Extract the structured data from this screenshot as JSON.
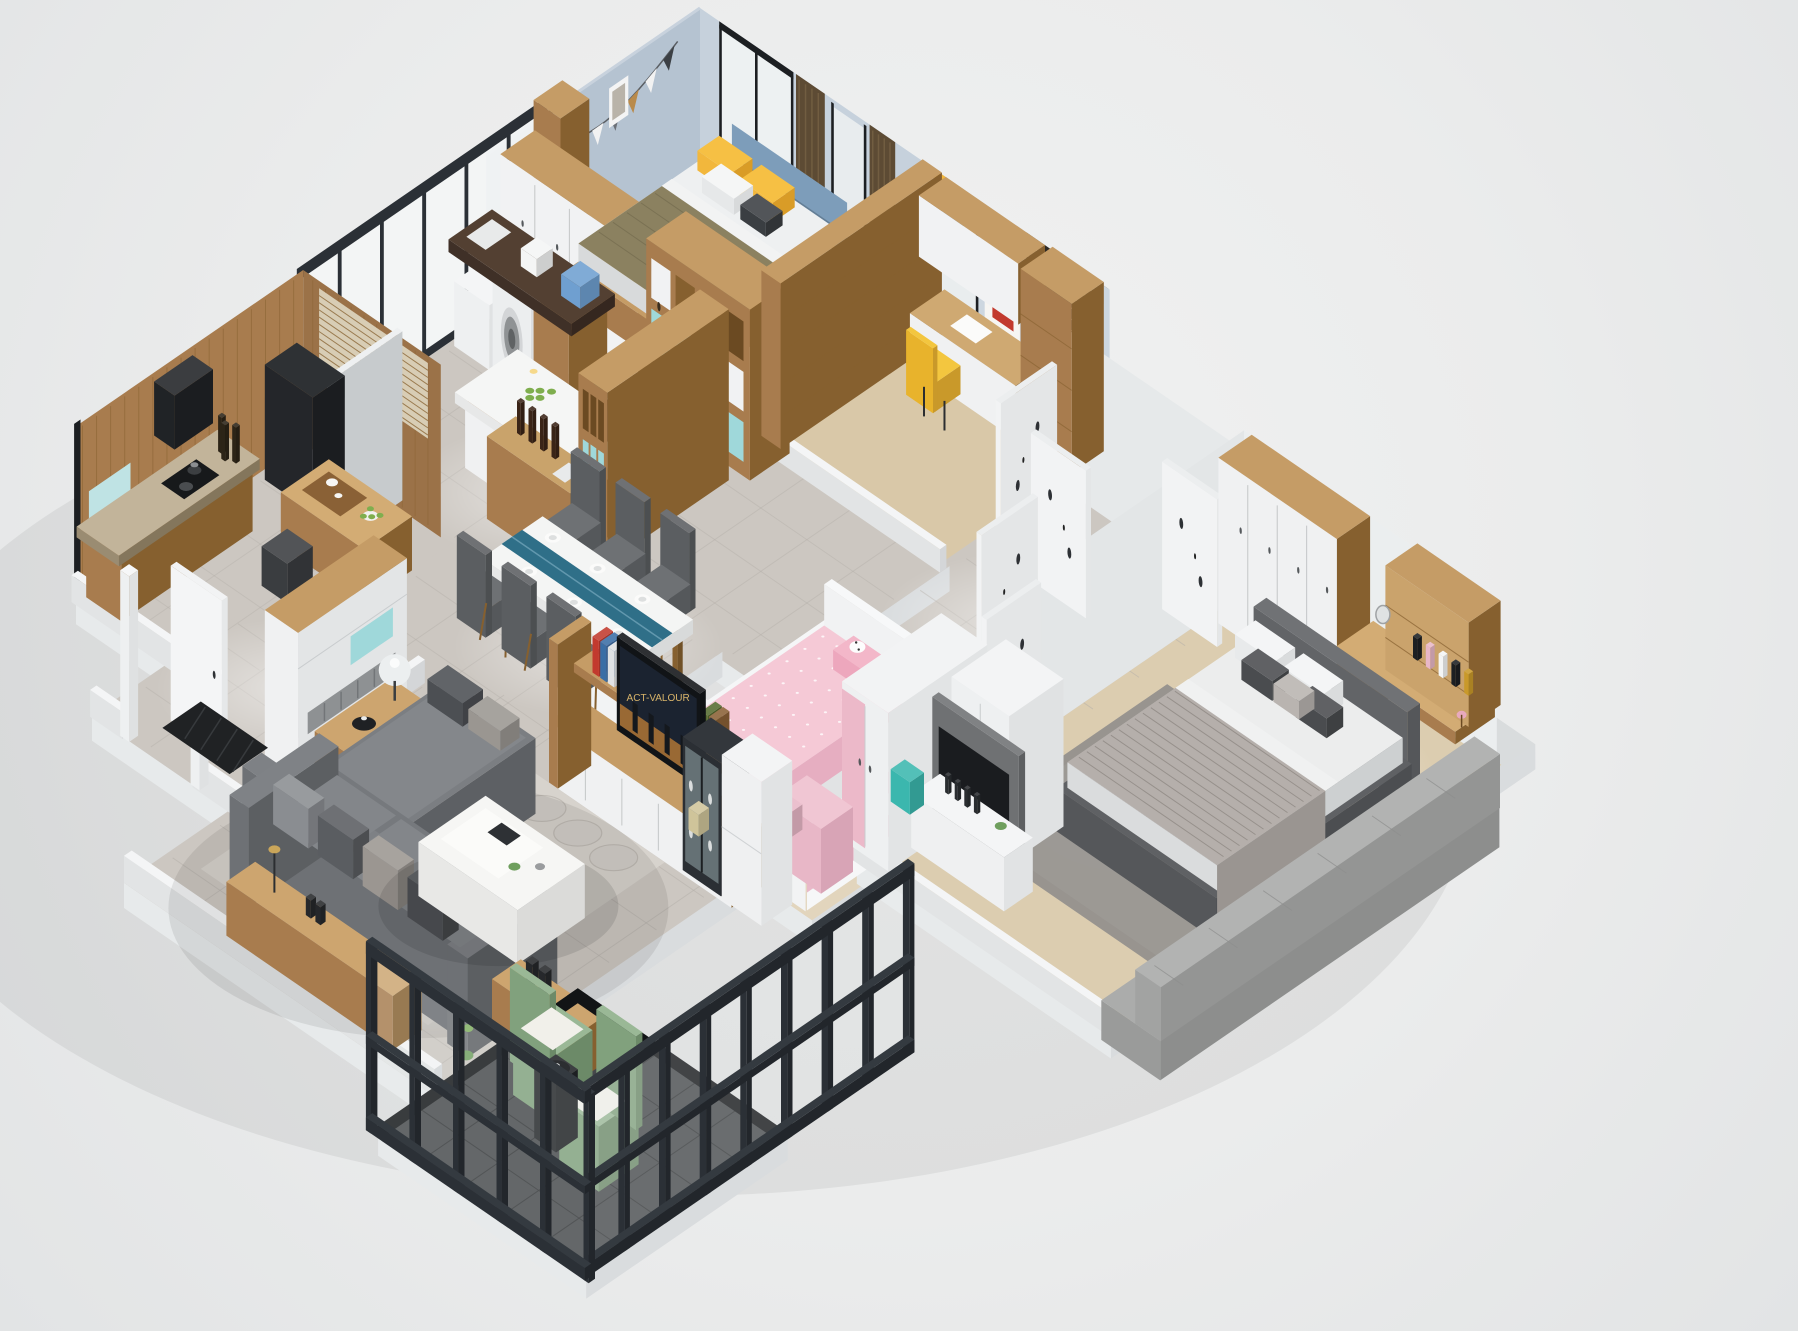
{
  "scene": {
    "description": "Isometric 3D cutaway render of a furnished three-bedroom apartment floor plan on a light gray studio background",
    "background_color": "#ebecec",
    "tv_screen_label": "ACT-VALOUR"
  },
  "palette": {
    "slab_top": "#d9dcdd",
    "slab_side": "#c9cdcf",
    "marble": "#ccc7c1",
    "marble_lt": "#dedad4",
    "tile_line": "#b4afa9",
    "wood": "#a87c4e",
    "wood_dk": "#86602f",
    "wood_lt": "#c59c66",
    "wood_floor": "#d9c8a8",
    "wood_floor2": "#e2d5bd",
    "wood_top": "#d3ac74",
    "white": "#f1f2f3",
    "white_dk": "#d7d9da",
    "gray_wall": "#e4e7e8",
    "blue_wall": "#b5c3d1",
    "blue_wall_lt": "#c6d1dc",
    "teal": "#9fd8da",
    "teal_dk": "#79c4c8",
    "yellow": "#f2b73c",
    "olive": "#8b8160",
    "head_blue": "#7d9dba",
    "pink": "#f5c9d6",
    "pink_dk": "#e6aec1",
    "sofa": "#6d7073",
    "sofa_dk": "#5a5d60",
    "sofa_lt": "#83868a",
    "green": "#81a17d",
    "green_lt": "#9ab896",
    "black": "#1c1f22",
    "frame": "#2b3036",
    "glass": "#f3f5f5",
    "granite": "#4e3d31",
    "granite_lt": "#c2b49a",
    "curtain": "#5d4b34",
    "curtain_lt": "#7a6547",
    "rug": "#d7d3cd",
    "rug_line": "#b7b2ac",
    "rug_gray": "#93908d",
    "bed_frame": "#5d5f62",
    "bedding": "#eceded",
    "throw": "#b5afab",
    "bench": "#a9aaa9",
    "balcony_floor": "#46484b",
    "balcony_line": "#2e3032",
    "mat": "#202224",
    "poster_red": "#c23a2e",
    "screen": "#1b2330",
    "screen_glow": "#b97b36",
    "label": "#d8b46a"
  },
  "rooms": [
    {
      "id": "bedroom-2",
      "label": "Teen bedroom with blue walls and yellow bedding",
      "furniture": [
        "white-door wardrobe",
        "single bed with yellow pillows",
        "bunting garland",
        "star and hexagon wall decor",
        "black framed windows",
        "brown curtains",
        "shelving divider"
      ]
    },
    {
      "id": "bedroom-3",
      "label": "Study bedroom",
      "furniture": [
        "desk with hutch",
        "yellow chair",
        "rhino-in-suit poster",
        "colorful wall shelves",
        "dark roller blind"
      ]
    },
    {
      "id": "hallway",
      "label": "Hallway with marble floor",
      "furniture": [
        "white doors with black leaf decals"
      ]
    },
    {
      "id": "master-bedroom",
      "label": "Master bedroom",
      "furniture": [
        "upholstered double bed",
        "striped throw",
        "wood wardrobe with white doors",
        "corner vanity desk with cosmetics hutch",
        "pleated pouf",
        "gray rug",
        "tv panel with white sideboard",
        "gray window bench platform"
      ]
    },
    {
      "id": "kids-room",
      "label": "Children's room",
      "furniture": [
        "white bed with pink hello-kitty bedding",
        "pink and white wardrobe",
        "pink desk",
        "pink striped wall"
      ]
    },
    {
      "id": "kitchen",
      "label": "Kitchen and laundry",
      "furniture": [
        "washing machine",
        "dark granite counter with sink",
        "wine and cubby shelving with teal boxes",
        "white marble island bar with bottles and grapes",
        "wood serving bar"
      ]
    },
    {
      "id": "tea-room",
      "label": "Wood panelled tea room",
      "furniture": [
        "slatted blind band",
        "black cabinet",
        "tea table with tea set and green apples",
        "granite stove counter",
        "mint accent panel"
      ]
    },
    {
      "id": "dining-room",
      "label": "Dining area",
      "furniture": [
        "white marble dining table",
        "teal table runner",
        "six dark fabric chairs",
        "place settings"
      ]
    },
    {
      "id": "entry",
      "label": "Entry hall",
      "furniture": [
        "shoe bench cabinet with teal cubby and gray cushion",
        "open white front door",
        "black patterned doormat"
      ]
    },
    {
      "id": "living-room",
      "label": "Living room",
      "furniture": [
        "dark gray corner sofa with chaise",
        "white marble organic coffee table",
        "wood console with globe lamp",
        "wood side bench",
        "circle-pattern rug",
        "wood and white tv media wall",
        "black glass display cabinet"
      ]
    },
    {
      "id": "balcony",
      "label": "Enclosed balcony",
      "furniture": [
        "black steel glass partition",
        "two green armchairs with white cushions",
        "small round black table",
        "dark marble tile floor"
      ]
    }
  ]
}
